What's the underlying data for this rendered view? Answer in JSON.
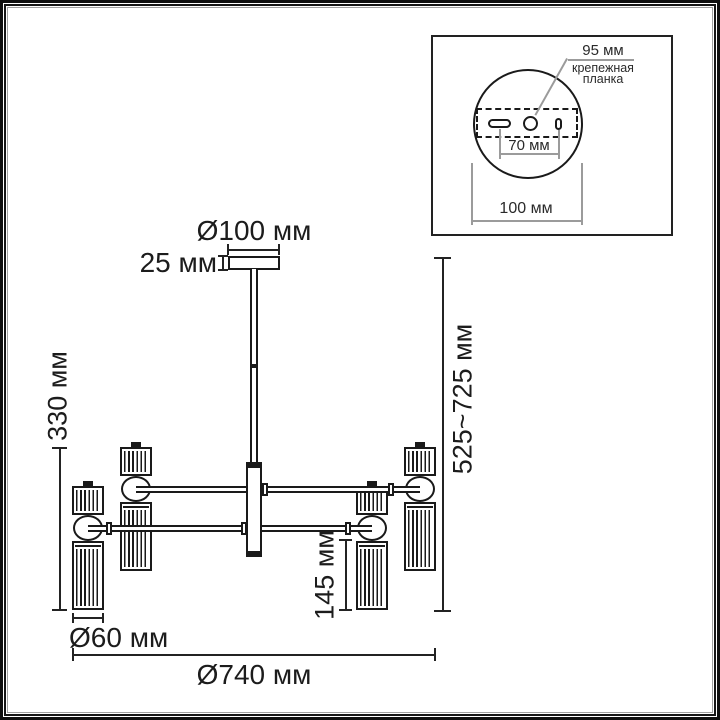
{
  "inset": {
    "dim_hole": "95 мм",
    "mount_plate_label": "крепежная планка",
    "dim_slot_spacing": "70 мм",
    "dim_base_width": "100 мм"
  },
  "dimensions": {
    "canopy_diameter": "Ø100 мм",
    "canopy_height": "25 мм",
    "body_height": "330 мм",
    "overall_height": "525~725 мм",
    "shade_length": "145 мм",
    "shade_diameter": "Ø60 мм",
    "overall_width": "Ø740 мм"
  }
}
